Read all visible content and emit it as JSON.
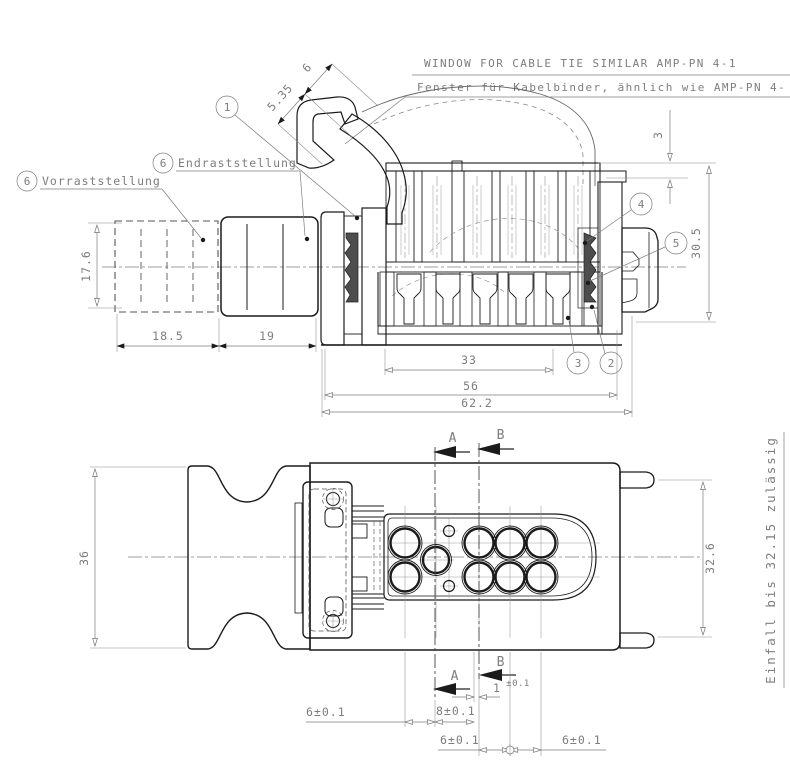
{
  "notes": {
    "window_note_en": "WINDOW FOR CABLE TIE SIMILAR AMP-PN 4-1",
    "window_note_de": "Fenster für Kabelbinder, ähnlich wie AMP-PN 4-",
    "einfall_note": "Einfall bis 32.15 zulässig"
  },
  "labels": {
    "vorrast": "Vorraststellung",
    "endrast": "Endraststellung"
  },
  "balloons": {
    "b1": "1",
    "b2": "2",
    "b3": "3",
    "b4": "4",
    "b5": "5",
    "b6": "6"
  },
  "side_dims": {
    "d535": "5.35",
    "d6": "6",
    "d3": "3",
    "d305": "30.5",
    "d176": "17.6",
    "d185": "18.5",
    "d19": "19",
    "d33": "33",
    "d56": "56",
    "d622": "62.2"
  },
  "plan_dims": {
    "d36": "36",
    "d326": "32.6",
    "d6_left": "6±0.1",
    "d8": "8±0.1",
    "d1": "1",
    "d1_tol": "±0.1",
    "d6_mid": "6±0.1",
    "d6_right": "6±0.1"
  },
  "sections": {
    "a": "A",
    "b": "B"
  },
  "colors": {
    "line": "#1b1b1b",
    "dim": "#7d7d7d",
    "seal": "#4d4d4d",
    "background": "#ffffff"
  }
}
